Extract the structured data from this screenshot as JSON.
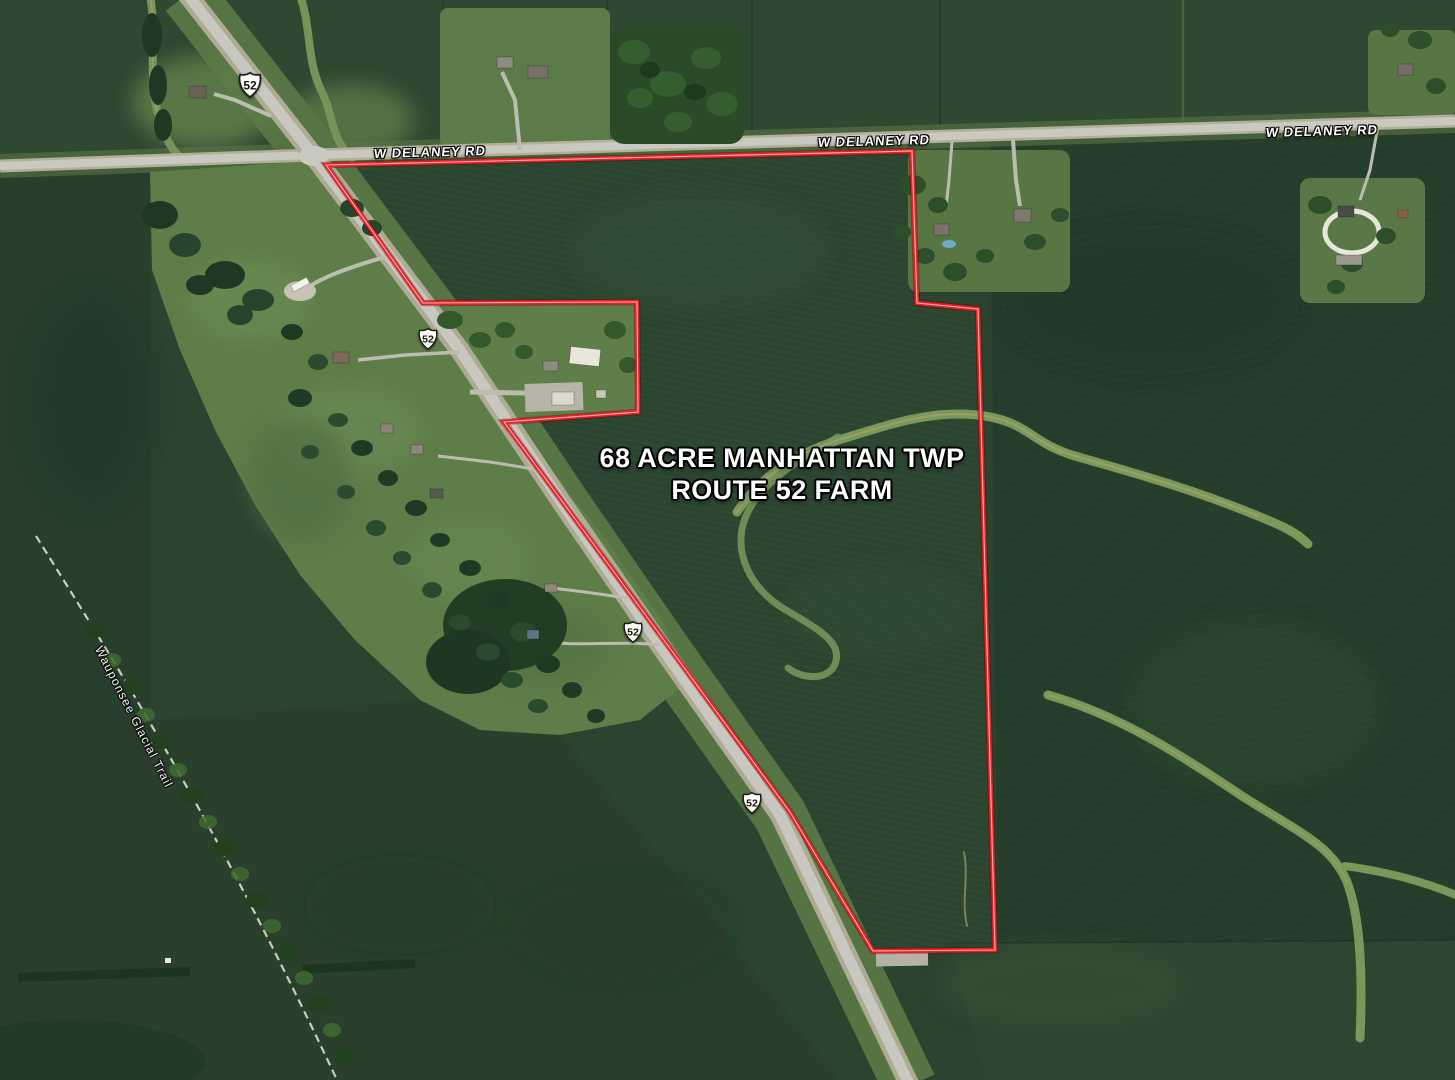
{
  "annotation": {
    "title_line1": "68 ACRE MANHATTAN TWP",
    "title_line2": "ROUTE 52 FARM",
    "outline_color": "#ee1c24",
    "parcel_points": "326,165 912,151 917,303 978,309 995,950 873,951 790,812 504,422 638,412 637,302 423,303"
  },
  "roads": {
    "delaney_labels": [
      {
        "text": "W DELANEY RD"
      },
      {
        "text": "W DELANEY RD"
      },
      {
        "text": "W DELANEY RD"
      }
    ],
    "route_shields": [
      {
        "number": "52"
      },
      {
        "number": "52"
      },
      {
        "number": "52"
      },
      {
        "number": "52"
      }
    ]
  },
  "trail": {
    "label": "Wauponsee Glacial Trail"
  }
}
